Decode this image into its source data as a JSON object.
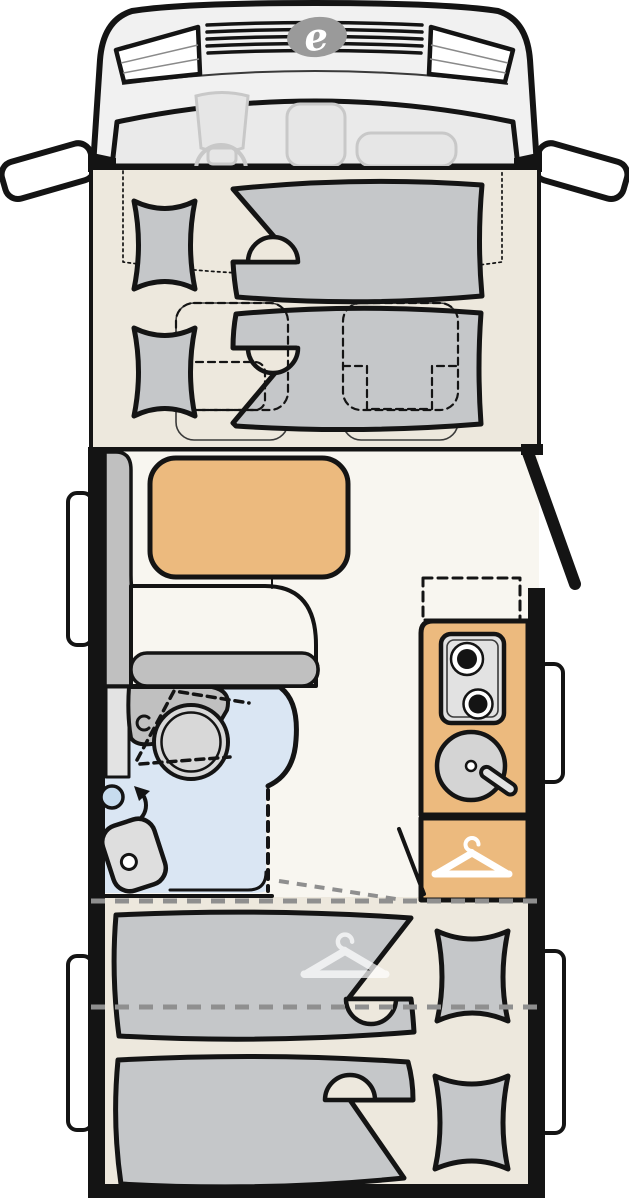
{
  "brand": {
    "logo_letter": "e"
  },
  "diagram": {
    "kind": "motorhome floor plan, top view",
    "rooms": [
      {
        "name": "driver-cab",
        "features": [
          "steering-wheel",
          "driver-seat",
          "middle-seat",
          "passenger-seat",
          "left-mirror",
          "right-mirror",
          "grille",
          "headlights",
          "brand-logo"
        ]
      },
      {
        "name": "front-bed-area",
        "features": [
          "left-pillow-top",
          "left-pillow-bottom",
          "duvet-top",
          "duvet-bottom",
          "dinette-seat-outline-left",
          "dinette-seat-outline-right",
          "drop-down-bed-dotted-outline"
        ]
      },
      {
        "name": "lounge",
        "features": [
          "l-shaped-bench",
          "dining-table",
          "entrance-door",
          "side-window"
        ]
      },
      {
        "name": "kitchen",
        "features": [
          "two-burner-hob",
          "round-sink",
          "faucet",
          "optional-unit-dashed",
          "kitchen-window"
        ]
      },
      {
        "name": "bathroom",
        "features": [
          "washbasin",
          "vanity-counter",
          "folding-door-dashed",
          "shower-head",
          "swivel-arrow",
          "toilet",
          "shower-tray"
        ]
      },
      {
        "name": "wardrobe",
        "features": [
          "clothes-hanger-icon"
        ]
      },
      {
        "name": "rear-bedroom",
        "features": [
          "single-bed-left",
          "single-bed-right",
          "pillow-left",
          "pillow-right",
          "under-bed-wardrobe-hanger",
          "rear-windows",
          "fold-line-dashed"
        ]
      }
    ]
  },
  "icons": [
    {
      "name": "brand-logo-icon",
      "meaning": "oval badge with letter e"
    },
    {
      "name": "hanger-icon",
      "meaning": "clothes hanger = wardrobe"
    },
    {
      "name": "burner-icon",
      "meaning": "gas hob burner"
    },
    {
      "name": "sink-icon",
      "meaning": "round kitchen sink with tap"
    }
  ],
  "colors": {
    "ink": "#141414",
    "cream": "#EDE8DD",
    "paper": "#F8F6F0",
    "blue": "#DAE6F3",
    "tan": "#ECBA7E",
    "bedgray": "#C5C7C9",
    "midgray": "#C0C0C0",
    "ltgray": "#E2E2E2",
    "cabgray": "#F1F1F1",
    "glassgray": "#EAEAEA",
    "faint": "#C8C8C8",
    "seatfill": "#E6E6E6",
    "logo": "#9A9A9A",
    "dashgray": "#8F8F8F",
    "white": "#FFFFFF"
  }
}
